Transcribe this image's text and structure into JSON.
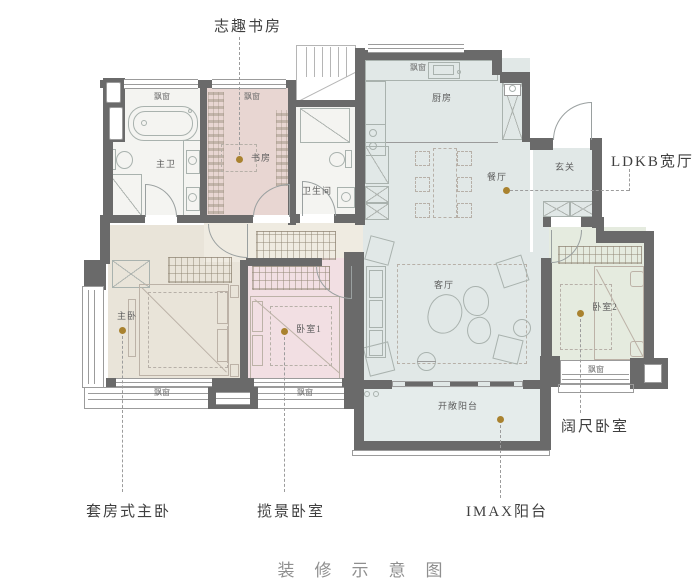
{
  "title": "装修示意图",
  "colors": {
    "wall": "#6a6a6a",
    "gold": "#a9822f",
    "line": "#a9b2ae",
    "win": "#9b9b9b",
    "floor_blue": "#e1e8e7",
    "floor_balcony": "#e5eceb",
    "floor_beige": "#e9e4d9",
    "floor_corridor": "#efebe1",
    "floor_pink_study": "#e8d6d2",
    "floor_pink_bed": "#f2dfe3",
    "floor_green": "#e5ebdf",
    "floor_bath": "#f4f4f1",
    "room_text": "#5c5c5c",
    "callout_text": "#3f3f3f",
    "title_text": "#8f8f8f"
  },
  "rooms": {
    "master_bath": "主卫",
    "study": "书房",
    "bathroom": "卫生间",
    "kitchen": "厨房",
    "dining": "餐厅",
    "foyer": "玄关",
    "living": "客厅",
    "master_bedroom": "主卧",
    "bedroom1": "卧室1",
    "bedroom2": "卧室2",
    "balcony": "开敞阳台"
  },
  "bay_window": "飘窗",
  "callouts": {
    "study": "志趣书房",
    "ldk": "LDKB宽厅",
    "master_suite": "套房式主卧",
    "scenic_bedroom": "揽景卧室",
    "wide_bedroom": "阔尺卧室",
    "imax_balcony": "IMAX阳台"
  }
}
